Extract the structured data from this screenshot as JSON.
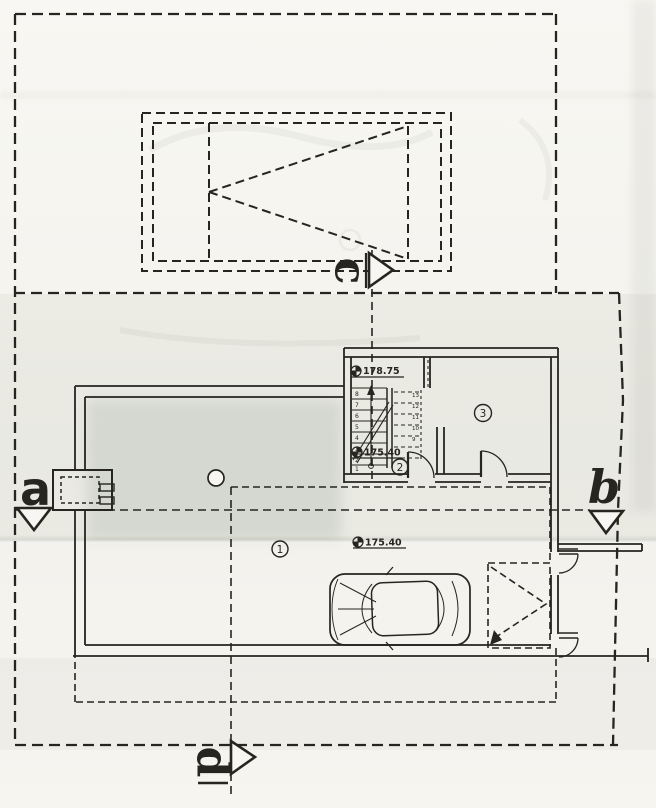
{
  "palette": {
    "ink": "#26251f",
    "paper": "#f7f6f2"
  },
  "section_markers": {
    "a": "a",
    "b": "b",
    "c": "c",
    "d": "d"
  },
  "elevations": {
    "upper_landing": "178.75",
    "stair_foot": "175.40",
    "garage_floor": "175.40"
  },
  "room_numbers": {
    "room1": "1",
    "room2": "2",
    "room3": "3"
  },
  "stair": {
    "lower_flight_numbers": [
      "1",
      "2",
      "3",
      "4",
      "5",
      "6",
      "7",
      "8"
    ],
    "upper_flight_numbers": [
      "9",
      "10",
      "11",
      "12",
      "13"
    ]
  }
}
